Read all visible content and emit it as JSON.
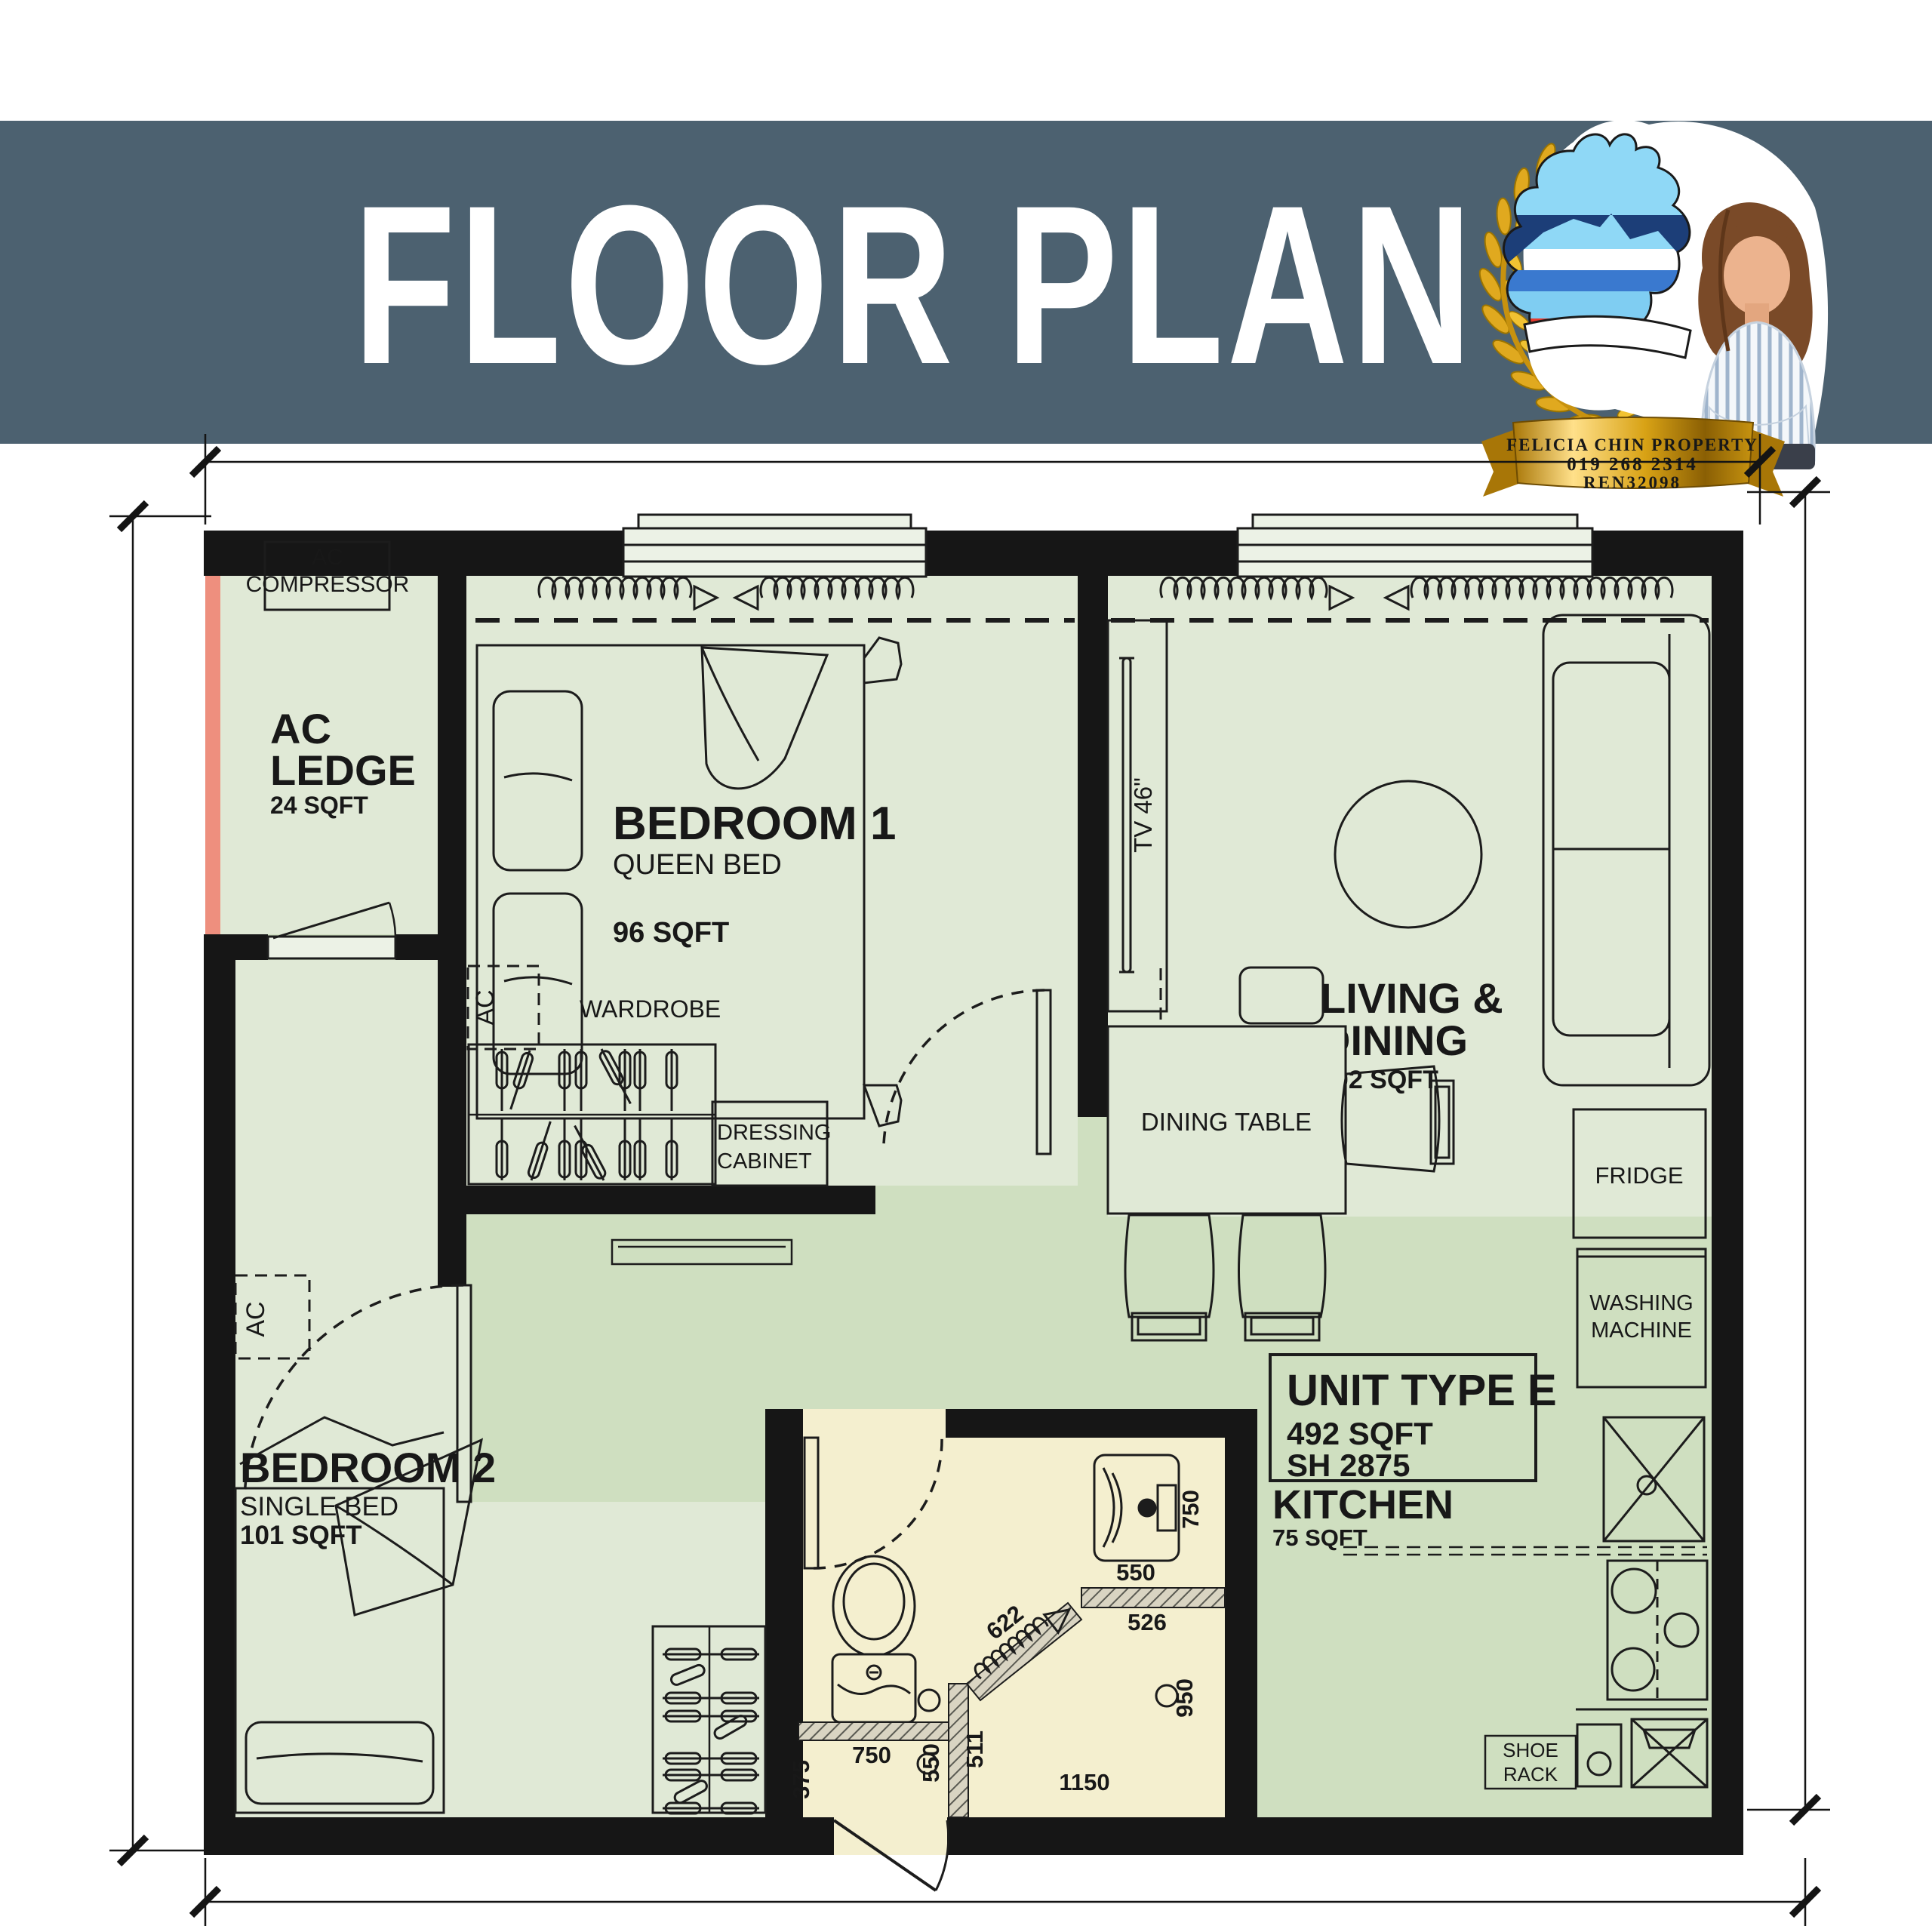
{
  "header": {
    "title": "FLOOR PLAN",
    "bg_color": "#4c6170",
    "text_color": "#ffffff"
  },
  "badge": {
    "agency": "FELICIA CHIN PROPERTY",
    "phone": "019 268 2314",
    "ren": "REN32098"
  },
  "plan": {
    "colors": {
      "wall": "#161616",
      "floor_light": "#e0e9d6",
      "floor_dark": "#cfdfc0",
      "bathroom": "#f4efcf",
      "ledge_vent": "#ee8f7e"
    },
    "rooms": {
      "ac_ledge": {
        "line1": "AC",
        "line2": "LEDGE",
        "area": "24 SQFT"
      },
      "ac_compressor": {
        "line1": "AC",
        "line2": "COMPRESSOR"
      },
      "bedroom1": {
        "name": "BEDROOM 1",
        "bed": "QUEEN BED",
        "area": "96 SQFT"
      },
      "bedroom2": {
        "name": "BEDROOM 2",
        "bed": "SINGLE BED",
        "area": "101 SQFT"
      },
      "living": {
        "line1": "LIVING &",
        "line2": "DINING",
        "area": "102 SQFT"
      },
      "kitchen": {
        "name": "KITCHEN",
        "area": "75 SQFT"
      }
    },
    "unit_info": {
      "type": "UNIT TYPE E",
      "area": "492 SQFT",
      "code": "SH 2875"
    },
    "furniture": {
      "wardrobe": "WARDROBE",
      "dressing_line1": "DRESSING",
      "dressing_line2": "CABINET",
      "dining_table": "DINING TABLE",
      "tv": "TV 46\"",
      "fridge": "FRIDGE",
      "washing_line1": "WASHING",
      "washing_line2": "MACHINE",
      "shoe_line1": "SHOE",
      "shoe_line2": "RACK",
      "ac": "AC"
    },
    "dimensions": {
      "basin_right": "750",
      "sink_top": "550",
      "sink_bottom": "526",
      "shower_diag": "622",
      "shower_right": "950",
      "shower_mid": "511",
      "shower_left": "550",
      "toilet_width": "750",
      "entry_left": "375",
      "bottom_width": "1150"
    }
  }
}
